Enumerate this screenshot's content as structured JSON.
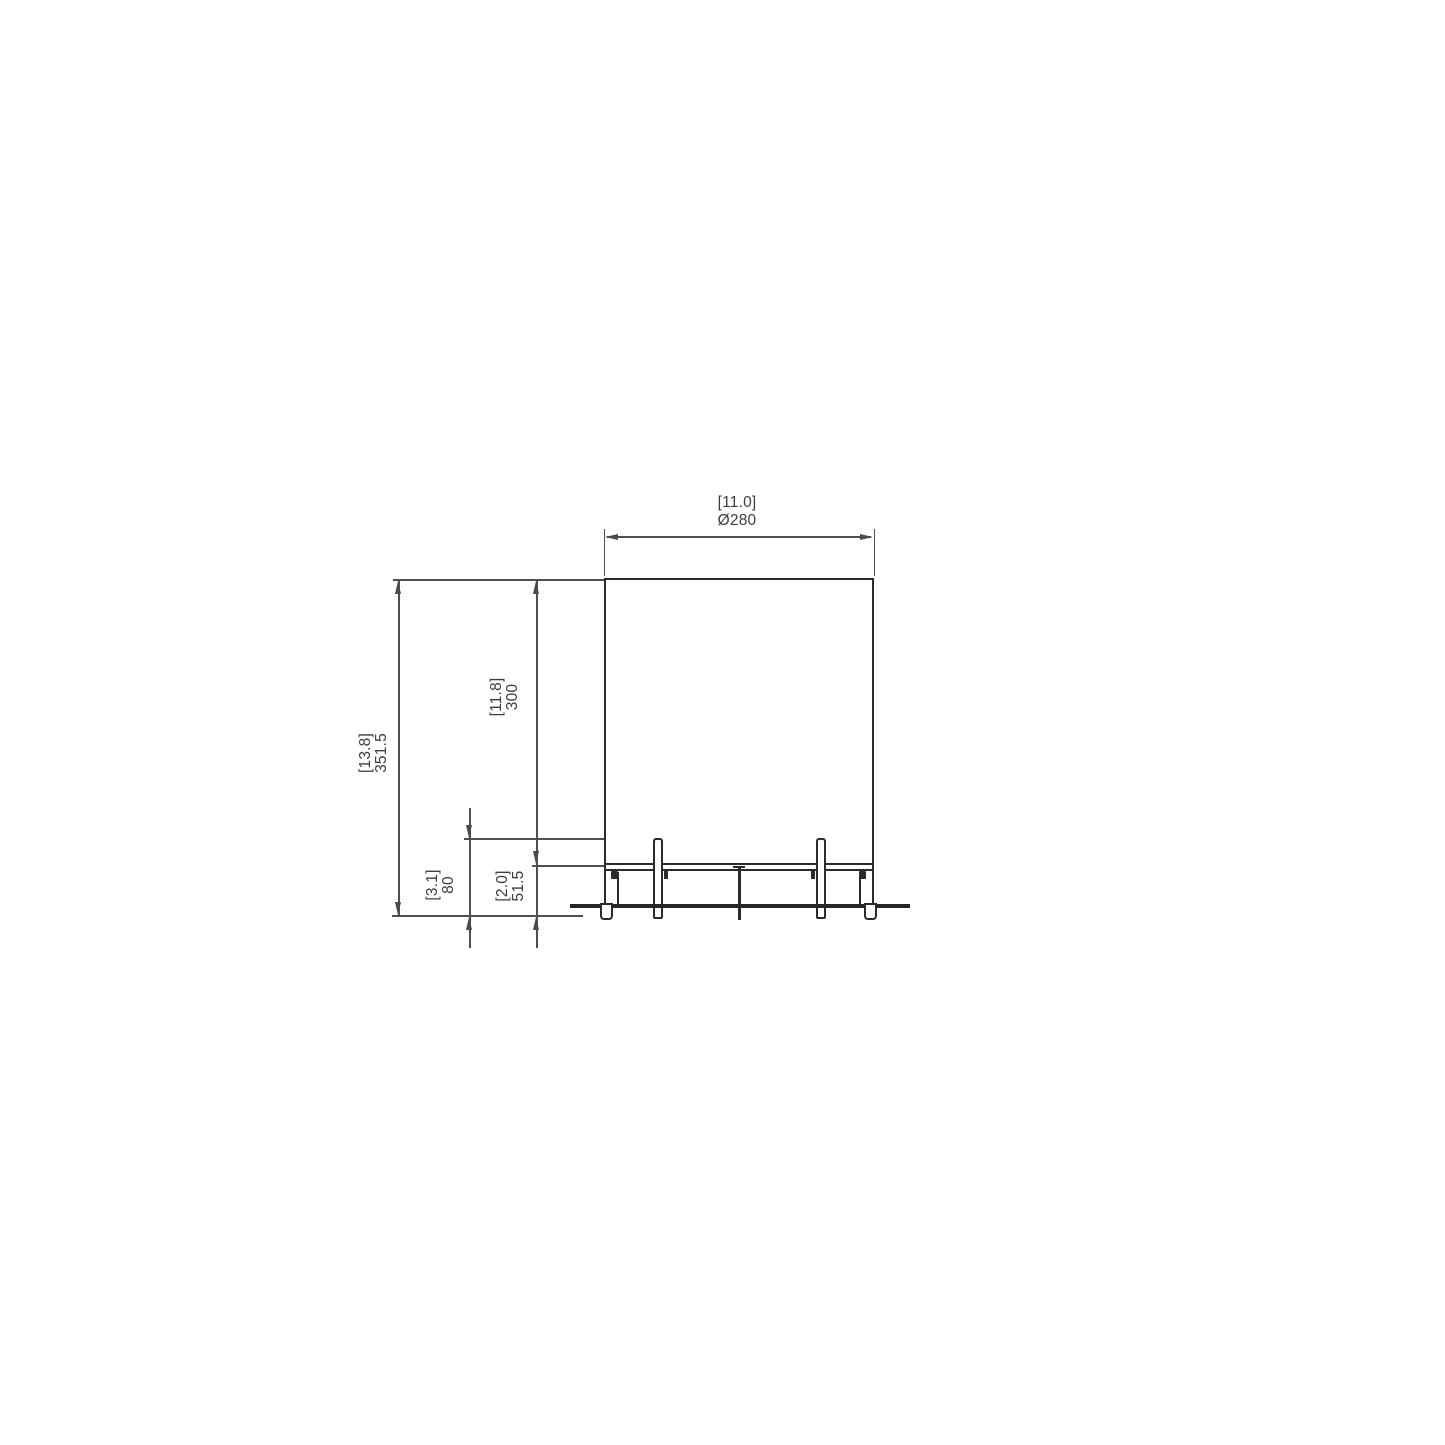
{
  "drawing": {
    "title": "front elevation technical drawing",
    "dimensions": {
      "width": {
        "inches": "[11.0]",
        "mm": "Ø280"
      },
      "total_height": {
        "inches": "[13.8]",
        "mm": "351.5"
      },
      "body_height": {
        "inches": "[11.8]",
        "mm": "300"
      },
      "base_height": {
        "inches": "[3.1]",
        "mm": "80"
      },
      "foot_clearance": {
        "inches": "[2.0]",
        "mm": "51.5"
      }
    },
    "colors": {
      "background": "#ffffff",
      "object_line": "#2b2b2b",
      "dimension_line": "#4f4f4f",
      "text": "#3d3d3d"
    }
  }
}
